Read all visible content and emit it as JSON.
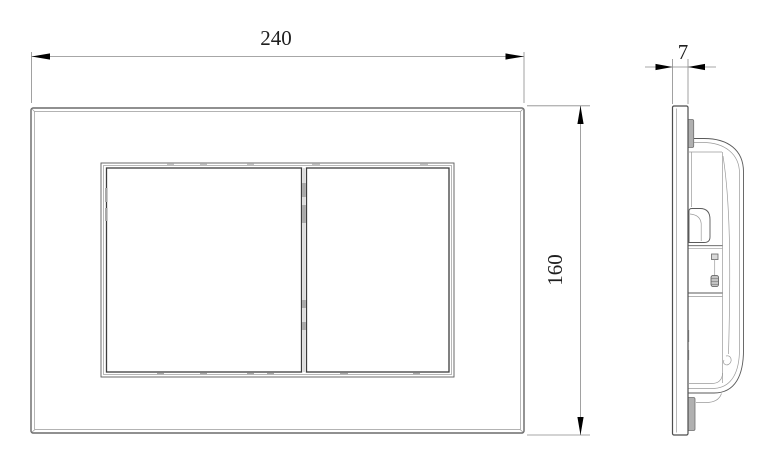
{
  "drawing": {
    "kind": "technical-dimension-drawing",
    "subject": "dual-flush actuator plate, front and side views",
    "dimensions": {
      "width": "240",
      "height": "160",
      "thickness": "7"
    },
    "colors": {
      "background": "#ffffff",
      "geometry_line": "#4d4d4d",
      "light_line": "#9a9a9a",
      "dimension_line": "#8a8a8a",
      "arrow": "#000000",
      "text": "#1f1f1f",
      "detail_gray_fill": "#b0b0b0"
    }
  }
}
